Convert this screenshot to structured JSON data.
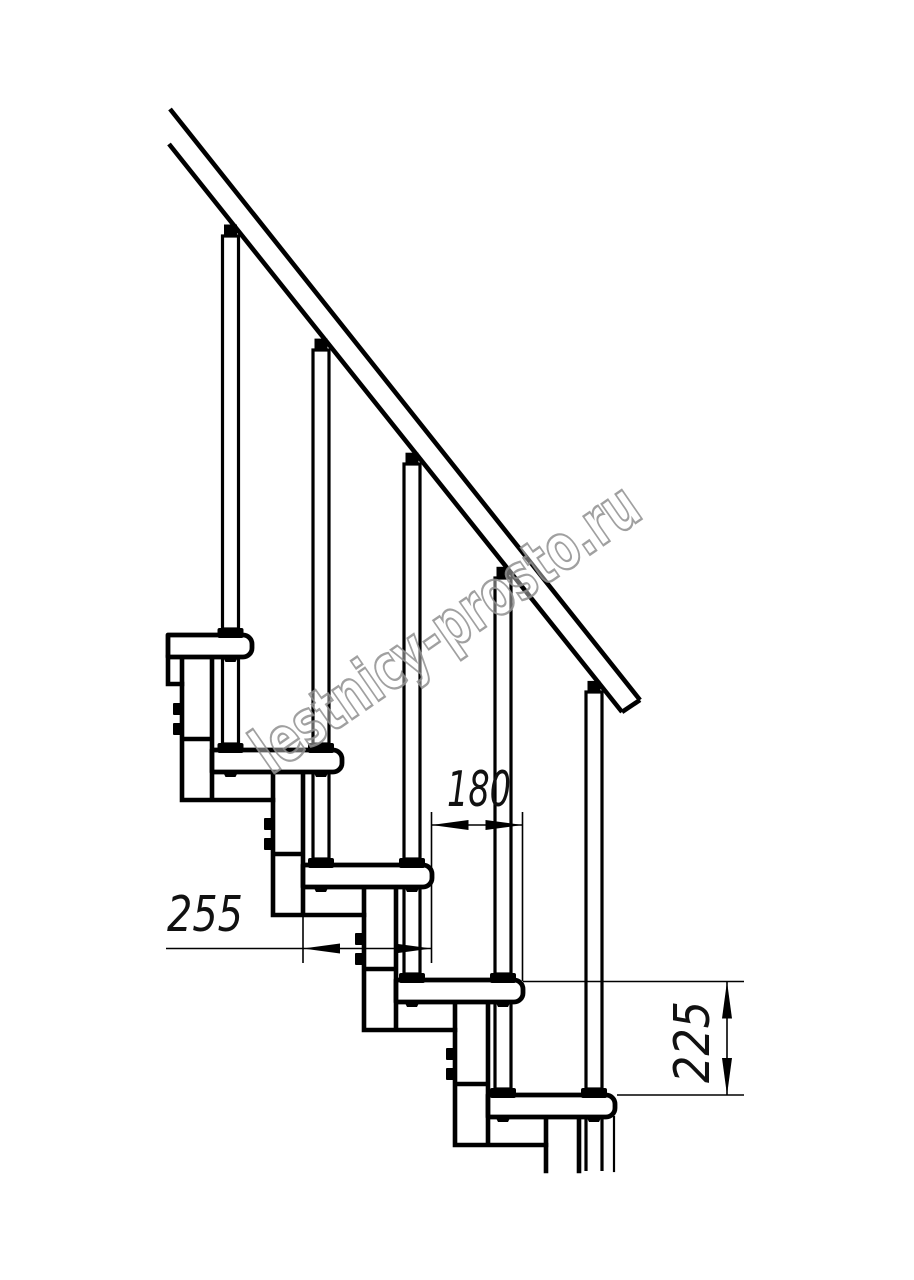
{
  "drawing": {
    "background": "#ffffff",
    "line_color": "#000000",
    "dimensions": {
      "depth_255": {
        "value": "255"
      },
      "run_180": {
        "value": "180"
      },
      "rise_225": {
        "value": "225"
      }
    },
    "watermark": {
      "text": "lestnicy-prosto.ru",
      "fill": "#ffffff",
      "stroke": "#8f8f8f"
    }
  }
}
